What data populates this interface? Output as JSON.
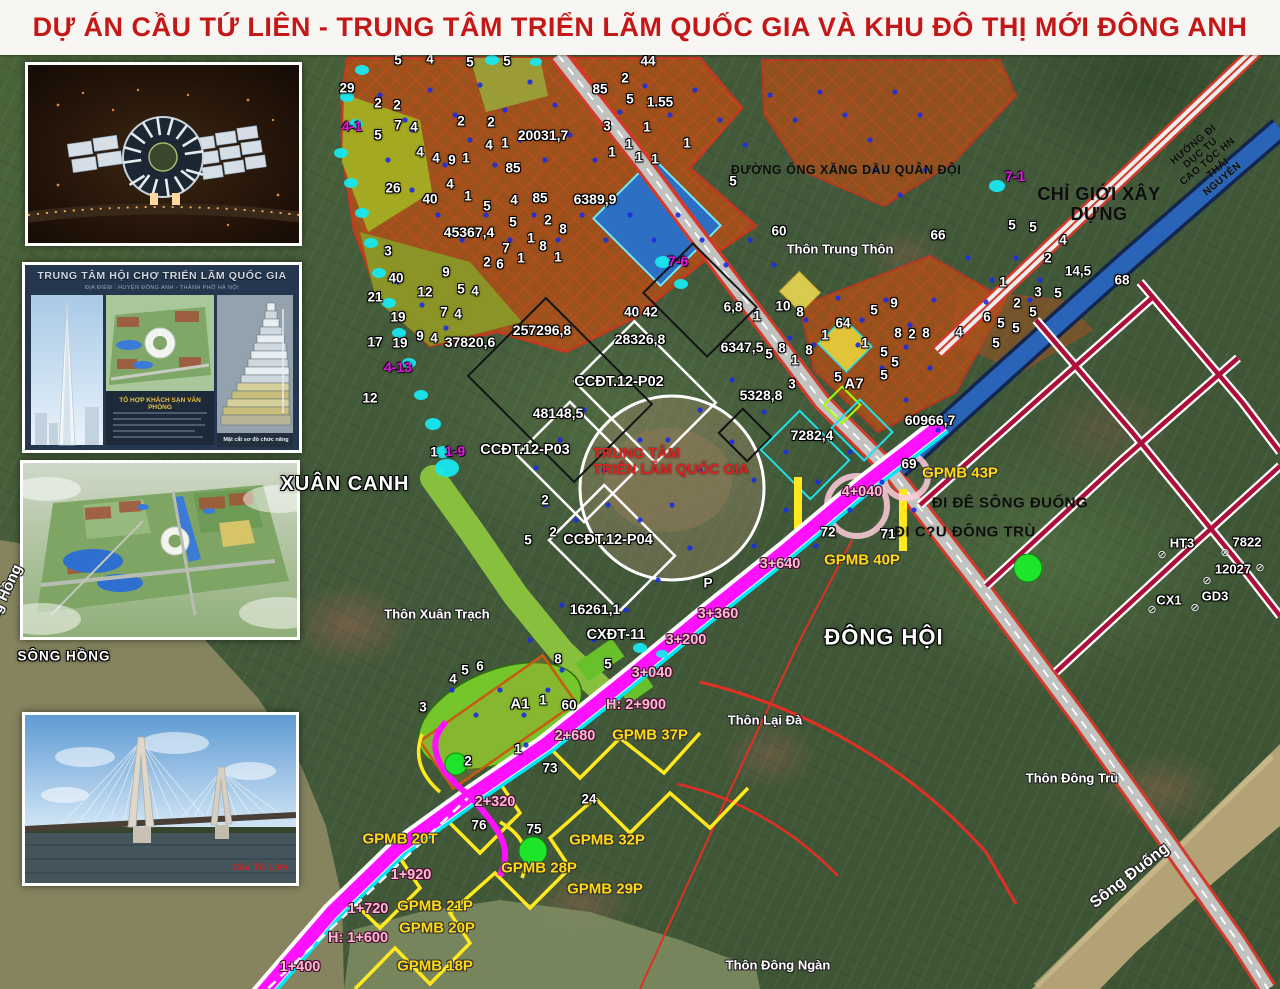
{
  "title": "DỰ ÁN CẦU TỨ LIÊN - TRUNG TÂM TRIỂN LÃM QUỐC GIA VÀ KHU ĐÔ THỊ MỚI ĐÔNG ANH",
  "colors": {
    "title_red": "#c41818",
    "route_magenta": "#ff10ff",
    "gpmb_yellow": "#ffd912",
    "chainage_pink": "#ffb9d4",
    "station_magenta": "#e018e0",
    "annotation_red": "#e42020",
    "cyan_marker": "#18e8f0",
    "green_dot": "#1ee52a"
  },
  "insets": {
    "night_render": {
      "name": "exhibition-center-night-aerial-photo"
    },
    "poster": {
      "title": "TRUNG TÂM HỘI CHỢ TRIỂN LÃM QUỐC GIA",
      "subtitle": "ĐỊA ĐIỂM : HUYỆN ĐÔNG ANH - THÀNH PHỐ HÀ NỘI",
      "panel_heading": "TỔ HỢP KHÁCH SẠN VĂN PHÒNG",
      "diagram_caption": "Mặt cắt sơ đồ chức năng"
    },
    "masterplan": {
      "name": "masterplan-aerial-render"
    },
    "bridge": {
      "caption": "Cầu Tứ Liên"
    }
  },
  "map": {
    "labels": [
      {
        "t": "29",
        "x": 347,
        "y": 88
      },
      {
        "t": "5",
        "x": 398,
        "y": 60
      },
      {
        "t": "4",
        "x": 430,
        "y": 59
      },
      {
        "t": "5",
        "x": 470,
        "y": 62
      },
      {
        "t": "5",
        "x": 507,
        "y": 61
      },
      {
        "t": "2",
        "x": 378,
        "y": 103
      },
      {
        "t": "2",
        "x": 397,
        "y": 105
      },
      {
        "t": "7",
        "x": 398,
        "y": 125
      },
      {
        "t": "4",
        "x": 414,
        "y": 127
      },
      {
        "t": "5",
        "x": 378,
        "y": 135
      },
      {
        "t": "2",
        "x": 461,
        "y": 121
      },
      {
        "t": "2",
        "x": 491,
        "y": 122
      },
      {
        "t": "4",
        "x": 420,
        "y": 152
      },
      {
        "t": "4",
        "x": 436,
        "y": 158
      },
      {
        "t": "9",
        "x": 452,
        "y": 160
      },
      {
        "t": "1",
        "x": 466,
        "y": 158
      },
      {
        "t": "4",
        "x": 489,
        "y": 145
      },
      {
        "t": "1",
        "x": 505,
        "y": 143
      },
      {
        "t": "85",
        "x": 513,
        "y": 168
      },
      {
        "t": "26",
        "x": 393,
        "y": 188
      },
      {
        "t": "40",
        "x": 430,
        "y": 199
      },
      {
        "t": "4",
        "x": 450,
        "y": 184
      },
      {
        "t": "1",
        "x": 468,
        "y": 196
      },
      {
        "t": "5",
        "x": 487,
        "y": 206
      },
      {
        "t": "4",
        "x": 514,
        "y": 200
      },
      {
        "t": "85",
        "x": 540,
        "y": 198
      },
      {
        "t": "20031,7",
        "x": 543,
        "y": 136,
        "s": 14
      },
      {
        "t": "6389,9",
        "x": 595,
        "y": 200,
        "s": 14
      },
      {
        "t": "45367,4",
        "x": 469,
        "y": 233,
        "s": 14
      },
      {
        "t": "5",
        "x": 513,
        "y": 222
      },
      {
        "t": "2",
        "x": 548,
        "y": 220
      },
      {
        "t": "8",
        "x": 563,
        "y": 229
      },
      {
        "t": "1",
        "x": 531,
        "y": 238
      },
      {
        "t": "8",
        "x": 543,
        "y": 246
      },
      {
        "t": "7",
        "x": 506,
        "y": 248
      },
      {
        "t": "2",
        "x": 487,
        "y": 262
      },
      {
        "t": "6",
        "x": 500,
        "y": 264
      },
      {
        "t": "1",
        "x": 521,
        "y": 258
      },
      {
        "t": "1",
        "x": 558,
        "y": 257
      },
      {
        "t": "3",
        "x": 388,
        "y": 251
      },
      {
        "t": "9",
        "x": 446,
        "y": 272
      },
      {
        "t": "44",
        "x": 648,
        "y": 61
      },
      {
        "t": "2",
        "x": 625,
        "y": 78
      },
      {
        "t": "85",
        "x": 600,
        "y": 89
      },
      {
        "t": "5",
        "x": 630,
        "y": 99
      },
      {
        "t": "1.55",
        "x": 660,
        "y": 102
      },
      {
        "t": "3",
        "x": 607,
        "y": 126
      },
      {
        "t": "1",
        "x": 647,
        "y": 127
      },
      {
        "t": "1",
        "x": 629,
        "y": 144
      },
      {
        "t": "1",
        "x": 612,
        "y": 152
      },
      {
        "t": "1",
        "x": 639,
        "y": 157
      },
      {
        "t": "1",
        "x": 655,
        "y": 159
      },
      {
        "t": "1",
        "x": 687,
        "y": 143
      },
      {
        "t": "5",
        "x": 733,
        "y": 181
      },
      {
        "t": "60",
        "x": 779,
        "y": 231
      },
      {
        "t": "21",
        "x": 375,
        "y": 297
      },
      {
        "t": "40",
        "x": 396,
        "y": 278
      },
      {
        "t": "12",
        "x": 425,
        "y": 292
      },
      {
        "t": "5",
        "x": 461,
        "y": 289
      },
      {
        "t": "4",
        "x": 475,
        "y": 291
      },
      {
        "t": "19",
        "x": 398,
        "y": 317
      },
      {
        "t": "7",
        "x": 444,
        "y": 312
      },
      {
        "t": "4",
        "x": 458,
        "y": 314
      },
      {
        "t": "9",
        "x": 420,
        "y": 336
      },
      {
        "t": "4",
        "x": 434,
        "y": 338
      },
      {
        "t": "17",
        "x": 375,
        "y": 342
      },
      {
        "t": "19",
        "x": 400,
        "y": 343
      },
      {
        "t": "37820,6",
        "x": 470,
        "y": 343,
        "s": 14
      },
      {
        "t": "257296,8",
        "x": 542,
        "y": 331,
        "s": 14
      },
      {
        "t": "40 42",
        "x": 641,
        "y": 312
      },
      {
        "t": "28326,8",
        "x": 640,
        "y": 340,
        "s": 14
      },
      {
        "t": "12",
        "x": 370,
        "y": 398
      },
      {
        "t": "48148,5",
        "x": 558,
        "y": 414,
        "s": 14
      },
      {
        "t": "1",
        "x": 434,
        "y": 452
      },
      {
        "t": "2",
        "x": 545,
        "y": 500
      },
      {
        "t": "2",
        "x": 553,
        "y": 532
      },
      {
        "t": "5",
        "x": 528,
        "y": 540
      },
      {
        "t": "CCĐT.12-P02",
        "x": 619,
        "y": 382,
        "s": 14.5
      },
      {
        "t": "CCĐT.12-P03",
        "x": 525,
        "y": 450,
        "s": 14.5
      },
      {
        "t": "CCĐT.12-P04",
        "x": 608,
        "y": 540,
        "s": 14.5
      },
      {
        "t": "16261,1",
        "x": 595,
        "y": 610,
        "s": 14
      },
      {
        "t": "CXĐT-11",
        "x": 616,
        "y": 635,
        "s": 14.5
      },
      {
        "t": "6,8",
        "x": 733,
        "y": 307
      },
      {
        "t": "1",
        "x": 757,
        "y": 316
      },
      {
        "t": "10",
        "x": 783,
        "y": 306
      },
      {
        "t": "8",
        "x": 800,
        "y": 312
      },
      {
        "t": "64",
        "x": 843,
        "y": 323
      },
      {
        "t": "1",
        "x": 825,
        "y": 335
      },
      {
        "t": "5",
        "x": 874,
        "y": 310
      },
      {
        "t": "9",
        "x": 894,
        "y": 303
      },
      {
        "t": "8",
        "x": 898,
        "y": 333
      },
      {
        "t": "2",
        "x": 912,
        "y": 334
      },
      {
        "t": "8",
        "x": 926,
        "y": 333
      },
      {
        "t": "1",
        "x": 865,
        "y": 343
      },
      {
        "t": "6347,5",
        "x": 742,
        "y": 348,
        "s": 14
      },
      {
        "t": "5",
        "x": 769,
        "y": 354
      },
      {
        "t": "8",
        "x": 782,
        "y": 348
      },
      {
        "t": "1",
        "x": 795,
        "y": 360
      },
      {
        "t": "8",
        "x": 809,
        "y": 350
      },
      {
        "t": "5",
        "x": 884,
        "y": 352
      },
      {
        "t": "5",
        "x": 895,
        "y": 362
      },
      {
        "t": "5",
        "x": 884,
        "y": 375
      },
      {
        "t": "3",
        "x": 792,
        "y": 384
      },
      {
        "t": "5",
        "x": 838,
        "y": 377
      },
      {
        "t": "A7",
        "x": 854,
        "y": 385,
        "s": 15
      },
      {
        "t": "5328,8",
        "x": 761,
        "y": 396,
        "s": 14
      },
      {
        "t": "7282,4",
        "x": 812,
        "y": 436,
        "s": 14
      },
      {
        "t": "60966,7",
        "x": 930,
        "y": 421,
        "s": 14
      },
      {
        "t": "69",
        "x": 909,
        "y": 464
      },
      {
        "t": "72",
        "x": 828,
        "y": 532
      },
      {
        "t": "71",
        "x": 888,
        "y": 534
      },
      {
        "t": "P",
        "x": 708,
        "y": 583
      },
      {
        "t": "66",
        "x": 938,
        "y": 235
      },
      {
        "t": "5",
        "x": 1012,
        "y": 225
      },
      {
        "t": "5",
        "x": 1033,
        "y": 227
      },
      {
        "t": "4",
        "x": 1063,
        "y": 240
      },
      {
        "t": "2",
        "x": 1048,
        "y": 258
      },
      {
        "t": "14,5",
        "x": 1078,
        "y": 271
      },
      {
        "t": "68",
        "x": 1122,
        "y": 280
      },
      {
        "t": "1",
        "x": 1003,
        "y": 282
      },
      {
        "t": "3",
        "x": 1038,
        "y": 292
      },
      {
        "t": "5",
        "x": 1058,
        "y": 293
      },
      {
        "t": "2",
        "x": 1017,
        "y": 303
      },
      {
        "t": "5",
        "x": 1033,
        "y": 312
      },
      {
        "t": "6",
        "x": 987,
        "y": 317
      },
      {
        "t": "5",
        "x": 1001,
        "y": 323
      },
      {
        "t": "5",
        "x": 1016,
        "y": 328
      },
      {
        "t": "4",
        "x": 959,
        "y": 332
      },
      {
        "t": "5",
        "x": 996,
        "y": 343
      },
      {
        "t": "8",
        "x": 558,
        "y": 659
      },
      {
        "t": "5",
        "x": 608,
        "y": 664
      },
      {
        "t": "4",
        "x": 453,
        "y": 679
      },
      {
        "t": "5",
        "x": 465,
        "y": 670
      },
      {
        "t": "6",
        "x": 480,
        "y": 666
      },
      {
        "t": "3",
        "x": 423,
        "y": 707
      },
      {
        "t": "A1",
        "x": 520,
        "y": 705,
        "s": 15
      },
      {
        "t": "1",
        "x": 543,
        "y": 700
      },
      {
        "t": "60",
        "x": 569,
        "y": 705
      },
      {
        "t": "1",
        "x": 518,
        "y": 749
      },
      {
        "t": "2",
        "x": 468,
        "y": 761
      },
      {
        "t": "73",
        "x": 550,
        "y": 768
      },
      {
        "t": "24",
        "x": 589,
        "y": 799
      },
      {
        "t": "76",
        "x": 479,
        "y": 825
      },
      {
        "t": "75",
        "x": 534,
        "y": 829
      },
      {
        "t": "HT3",
        "x": 1182,
        "y": 544,
        "s": 13
      },
      {
        "t": "7822",
        "x": 1247,
        "y": 543,
        "s": 13
      },
      {
        "t": "12027",
        "x": 1233,
        "y": 570,
        "s": 13
      },
      {
        "t": "CX1",
        "x": 1169,
        "y": 601,
        "s": 13
      },
      {
        "t": "GD3",
        "x": 1215,
        "y": 597,
        "s": 13
      },
      {
        "t": "⊘",
        "x": 1162,
        "y": 555,
        "c": "sym"
      },
      {
        "t": "⊘",
        "x": 1225,
        "y": 553,
        "c": "sym"
      },
      {
        "t": "⊘",
        "x": 1260,
        "y": 568,
        "c": "sym"
      },
      {
        "t": "⊘",
        "x": 1207,
        "y": 581,
        "c": "sym"
      },
      {
        "t": "⊘",
        "x": 1152,
        "y": 610,
        "c": "sym"
      },
      {
        "t": "⊘",
        "x": 1195,
        "y": 608,
        "c": "sym"
      },
      {
        "t": "XUÂN CANH",
        "x": 345,
        "y": 484,
        "c": "wb",
        "s": 20
      },
      {
        "t": "ĐÔNG HỘI",
        "x": 884,
        "y": 638,
        "c": "wb",
        "s": 22
      },
      {
        "t": "SÔNG HỒNG",
        "x": 64,
        "y": 656,
        "c": "wb",
        "s": 13.5
      },
      {
        "t": "Sông Hồng",
        "x": 2,
        "y": 602,
        "c": "wp",
        "s": 15,
        "r": -65
      },
      {
        "t": "Thôn Trung Thôn",
        "x": 840,
        "y": 250,
        "c": "wp"
      },
      {
        "t": "Thôn Xuân Trạch",
        "x": 437,
        "y": 615,
        "c": "wp"
      },
      {
        "t": "Thôn Lại Đà",
        "x": 765,
        "y": 721,
        "c": "wp"
      },
      {
        "t": "Thôn Đông Trù",
        "x": 1072,
        "y": 779,
        "c": "wp"
      },
      {
        "t": "Thôn Đông Ngàn",
        "x": 778,
        "y": 966,
        "c": "wp"
      },
      {
        "t": "Sông Đuống",
        "x": 1130,
        "y": 876,
        "c": "wp",
        "s": 16,
        "r": -38
      },
      {
        "t": "CHỈ GIỚI XÂY DỰNG",
        "x": 1099,
        "y": 204,
        "c": "k",
        "s": 18
      },
      {
        "t": "ĐƯỜNG ỐNG XĂNG DẦU QUÂN ĐỘI",
        "x": 846,
        "y": 170,
        "c": "k",
        "s": 12.5
      },
      {
        "t": "ĐI ĐÊ SÔNG ĐUỐNG",
        "x": 1010,
        "y": 504,
        "c": "k",
        "s": 15
      },
      {
        "t": "ĐI C?U ĐÔNG TRÙ",
        "x": 965,
        "y": 533,
        "c": "k",
        "s": 15
      },
      {
        "t": "HƯỚNG ĐI DỤC TÚ\nCAO TỐC HN - THÁI NGUYÊN",
        "x": 1208,
        "y": 162,
        "c": "k",
        "s": 10,
        "r": -40
      },
      {
        "t": "TRUNG TÂM\nTRIỂN LÃM QUỐC GIA",
        "x": 671,
        "y": 462,
        "c": "r",
        "s": 14.5
      },
      {
        "t": "4-1",
        "x": 352,
        "y": 127,
        "c": "m"
      },
      {
        "t": "4-13",
        "x": 398,
        "y": 368,
        "c": "m"
      },
      {
        "t": "1-9",
        "x": 455,
        "y": 452,
        "c": "m"
      },
      {
        "t": "7-6",
        "x": 678,
        "y": 262,
        "c": "m"
      },
      {
        "t": "7-1",
        "x": 1015,
        "y": 177,
        "c": "m"
      },
      {
        "t": "GPMB 43P",
        "x": 960,
        "y": 474,
        "c": "y"
      },
      {
        "t": "GPMB 40P",
        "x": 862,
        "y": 561,
        "c": "y"
      },
      {
        "t": "GPMB 37P",
        "x": 650,
        "y": 736,
        "c": "y"
      },
      {
        "t": "GPMB 32P",
        "x": 607,
        "y": 841,
        "c": "y"
      },
      {
        "t": "GPMB 28P",
        "x": 539,
        "y": 869,
        "c": "y"
      },
      {
        "t": "GPMB 29P",
        "x": 605,
        "y": 890,
        "c": "y"
      },
      {
        "t": "GPMB 20T",
        "x": 400,
        "y": 840,
        "c": "y"
      },
      {
        "t": "GPMB 21P",
        "x": 435,
        "y": 907,
        "c": "y"
      },
      {
        "t": "GPMB 20P",
        "x": 437,
        "y": 929,
        "c": "y"
      },
      {
        "t": "GPMB 18P",
        "x": 435,
        "y": 967,
        "c": "y"
      },
      {
        "t": "4+040",
        "x": 862,
        "y": 492,
        "c": "p"
      },
      {
        "t": "3+640",
        "x": 780,
        "y": 564,
        "c": "p"
      },
      {
        "t": "3+360",
        "x": 718,
        "y": 614,
        "c": "p"
      },
      {
        "t": "3+200",
        "x": 686,
        "y": 640,
        "c": "p"
      },
      {
        "t": "3+040",
        "x": 652,
        "y": 673,
        "c": "p"
      },
      {
        "t": "H: 2+900",
        "x": 636,
        "y": 705,
        "c": "p"
      },
      {
        "t": "2+680",
        "x": 575,
        "y": 736,
        "c": "p"
      },
      {
        "t": "2+320",
        "x": 495,
        "y": 802,
        "c": "p"
      },
      {
        "t": "1+920",
        "x": 411,
        "y": 875,
        "c": "p"
      },
      {
        "t": "1+720",
        "x": 368,
        "y": 909,
        "c": "p"
      },
      {
        "t": "H: 1+600",
        "x": 358,
        "y": 938,
        "c": "p"
      },
      {
        "t": "1+400",
        "x": 300,
        "y": 967,
        "c": "p"
      }
    ]
  }
}
